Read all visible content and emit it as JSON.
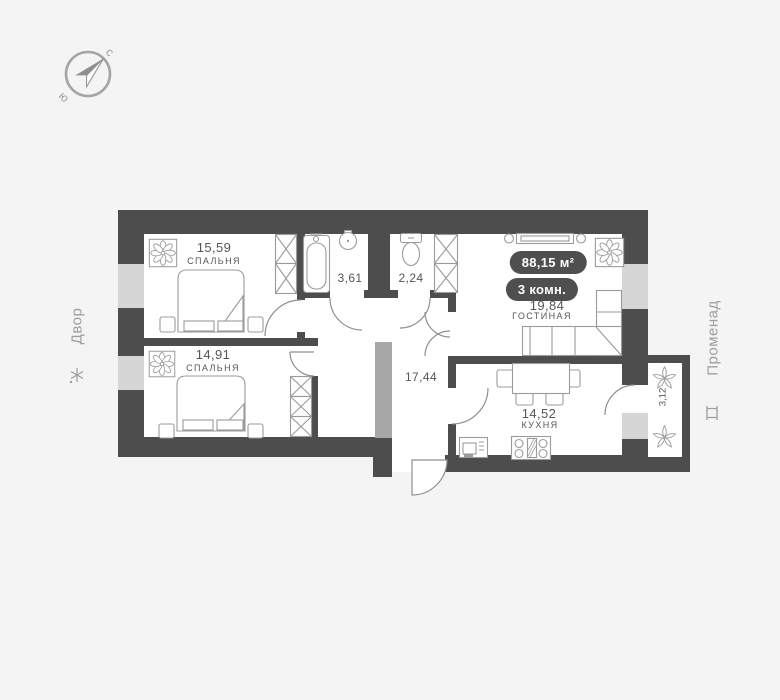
{
  "compass": {
    "north": "с",
    "south": "ю"
  },
  "surroundings": {
    "left": {
      "label": "Двор"
    },
    "right": {
      "label": "Променад"
    }
  },
  "apartment": {
    "total_area": "88,15 м²",
    "rooms_badge": "3 комн."
  },
  "rooms": {
    "bedroom1": {
      "area": "15,59",
      "name": "СПАЛЬНЯ"
    },
    "bedroom2": {
      "area": "14,91",
      "name": "СПАЛЬНЯ"
    },
    "bathroom": {
      "area": "3,61"
    },
    "wc": {
      "area": "2,24"
    },
    "hallway": {
      "area": "17,44"
    },
    "living": {
      "area": "19,84",
      "name": "ГОСТИНАЯ"
    },
    "kitchen": {
      "area": "14,52",
      "name": "КУХНЯ"
    },
    "balcony": {
      "area": "3,12"
    }
  },
  "icons": {
    "compass": "compass-icon",
    "tree": "tree-icon",
    "bench": "bench-icon",
    "plant": "plant-icon",
    "leaves": "leaf-icon"
  },
  "colors": {
    "background": "#f4f4f4",
    "floor": "#ffffff",
    "wall": "#4d4d4d",
    "window": "#d6d6d6",
    "partition_light": "#a7a7a7",
    "furniture_outline": "#9b9b9b",
    "label_text": "#565656",
    "badge_background": "#4f4f4f",
    "badge_text": "#ffffff",
    "surroundings_text": "#9e9e9e"
  }
}
